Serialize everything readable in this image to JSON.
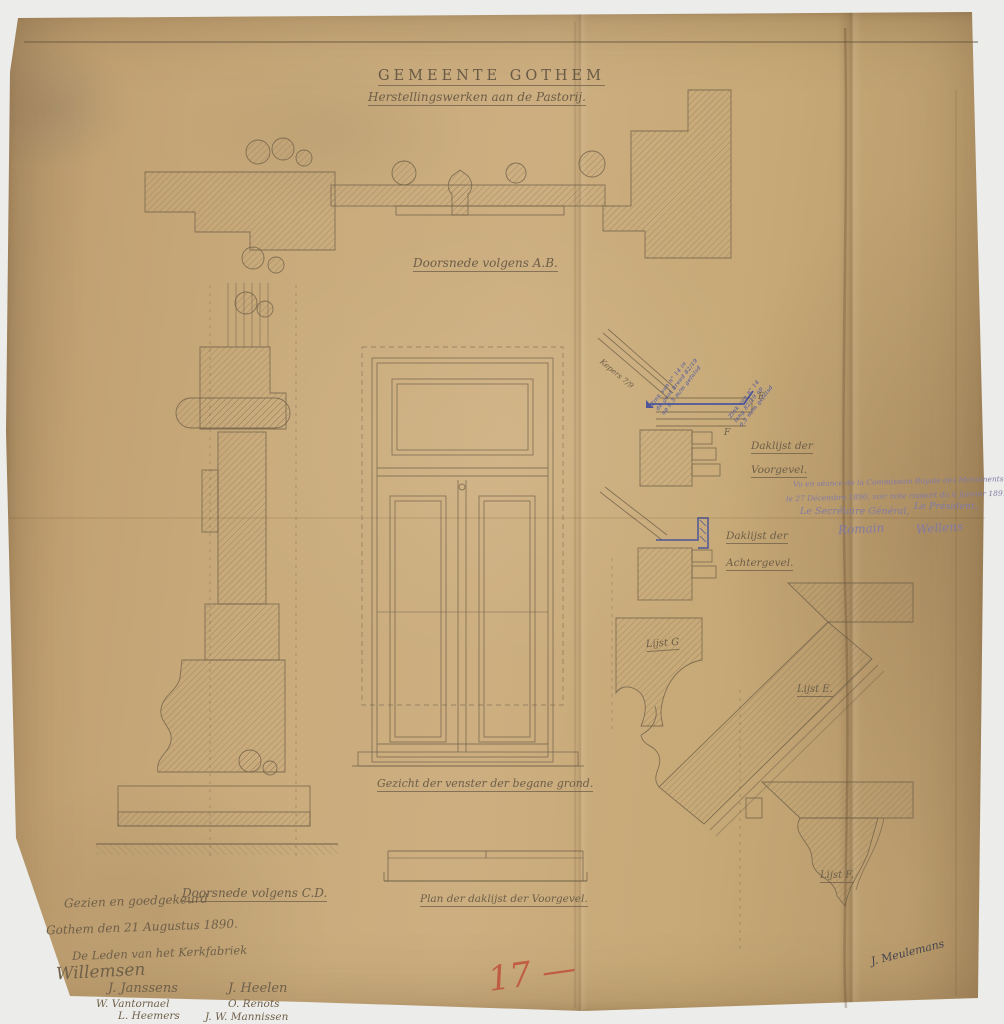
{
  "paper": {
    "title": "GEMEENTE GOTHEM",
    "subtitle": "Herstellingswerken aan de Pastorij.",
    "figure_labels": {
      "section_ab": "Doorsnede volgens A.B.",
      "window_elevation": "Gezicht der venster der begane grond.",
      "section_cd": "Doorsnede volgens C.D.",
      "plan_cornice": "Plan der daklijst der Voorgevel.",
      "cornice_front_1": "Daklijst der",
      "cornice_front_2": "Voorgevel.",
      "cornice_rear_1": "Daklijst der",
      "cornice_rear_2": "Achtergevel.",
      "lijst_g": "Lijst G",
      "lijst_e": "Lijst E.",
      "lijst_f": "Lijst F.",
      "rafter_note": "Kepers 7/9"
    },
    "reference_letters": {
      "e": "E",
      "f": "F"
    },
    "blue_notes": {
      "gutter_left": "Zink van n° 14 in\nde goot breed 82/19\nop 0,5 m/m gefalsd",
      "gutter_right": "Zink van n° 14\nlang 82/19 op\n0,5 m/m gefalsd"
    },
    "commission_note": {
      "line1": "Vu en séance de la Commission Royale des Monuments,",
      "line2": "le 27 Décembre 1890, voir note rapport du 6 Janvier 1891. N° 1890.",
      "secretary_title": "Le Secrétaire Général,",
      "secretary_signature": "Romain",
      "president_title": "Le Président,",
      "president_signature": "Wellens"
    },
    "approval": {
      "line1": "Gezien en goedgekeurd",
      "line2": "Gothem den 21 Augustus 1890.",
      "line3": "De Leden van het Kerkfabriek",
      "main_signature": "Willemsen",
      "row1_left": "J. Janssens",
      "row1_right": "J. Heelen",
      "row2_left": "W. Vantornael",
      "row2_right": "O. Renots",
      "row3_left": "L. Heemers",
      "row3_right": "J. W. Mannissen"
    },
    "page_number": "17 —",
    "corner_signature": "J. Meulemans",
    "colors": {
      "paper": "#c8aa78",
      "pencil": "#6f6049",
      "blue_ink": "#3646a0",
      "red_pencil": "#c0503a"
    }
  }
}
